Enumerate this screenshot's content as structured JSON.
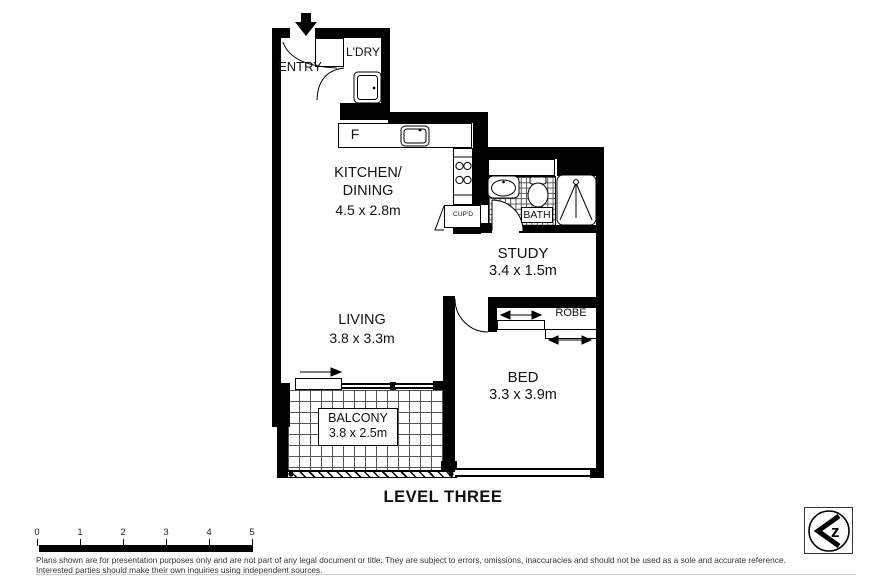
{
  "title": "LEVEL THREE",
  "rooms": {
    "entry": {
      "name": "ENTRY"
    },
    "laundry": {
      "name": "L'DRY"
    },
    "kitchen": {
      "line1": "KITCHEN/",
      "line2": "DINING",
      "dims": "4.5 x 2.8m"
    },
    "bath": {
      "name": "BATH"
    },
    "study": {
      "name": "STUDY",
      "dims": "3.4 x 1.5m"
    },
    "living": {
      "name": "LIVING",
      "dims": "3.8 x 3.3m"
    },
    "robe": {
      "name": "ROBE"
    },
    "bed": {
      "name": "BED",
      "dims": "3.3 x 3.9m"
    },
    "balcony": {
      "name": "BALCONY",
      "dims": "3.8 x 2.5m"
    }
  },
  "fixtures": {
    "fridge_label": "F",
    "cupboard_label": "CUP'D"
  },
  "scale_bar": {
    "labels": [
      "0",
      "1",
      "2",
      "3",
      "4",
      "5"
    ]
  },
  "footer": {
    "line1": "Plans shown are for presentation purposes only and are not part of any legal document or title. They are subject to errors, omissions, inaccuracies and should not be used as a sole and accurate reference.",
    "line2": "Interested parties should make their own inquiries using independent sources."
  },
  "logo": {
    "letter": "z"
  },
  "colors": {
    "wall": "#000000",
    "background": "#ffffff",
    "tile_line": "#555555"
  }
}
